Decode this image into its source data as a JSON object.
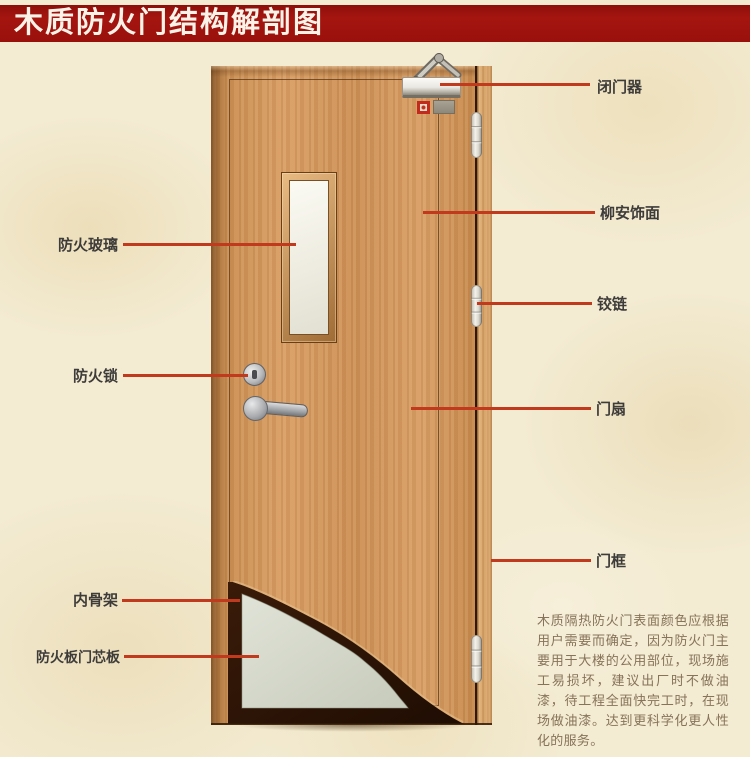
{
  "title": "木质防火门结构解剖图",
  "labels": {
    "left": [
      {
        "text": "防火玻璃"
      },
      {
        "text": "防火锁"
      },
      {
        "text": "内骨架"
      },
      {
        "text": "防火板门芯板"
      }
    ],
    "right": [
      {
        "text": "闭门器"
      },
      {
        "text": "柳安饰面"
      },
      {
        "text": "铰链"
      },
      {
        "text": "门扇"
      },
      {
        "text": "门框"
      }
    ]
  },
  "description": "木质隔热防火门表面颜色应根据用户需要而确定，因为防火门主要用于大楼的公用部位，现场施工易损坏，建议出厂时不做油漆，待工程全面快完工时，在现场做油漆。达到更科学化更人性化的服务。",
  "colors": {
    "banner_red": "#9e120c",
    "callout_red": "#c23a1e",
    "background_beige": "#f3ebd2",
    "door_wood": "#d0945a",
    "door_frame_wood": "#d8a771",
    "core_panel_gray": "#d6d9cc",
    "inner_skeleton_dark": "#2d1406",
    "label_text": "#3e3c3a",
    "description_text": "#86735a",
    "title_text": "#fbf3e8"
  }
}
